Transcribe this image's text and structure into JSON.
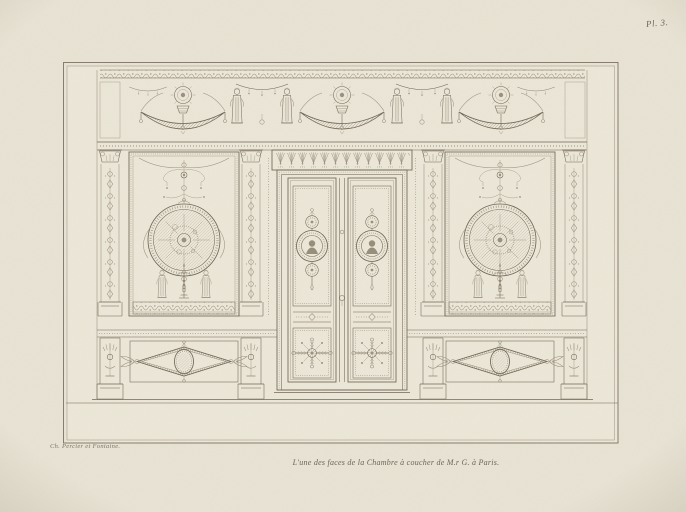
{
  "plate": {
    "number": "Pl. 3.",
    "signature": "Ch. Percier et Fontaine.",
    "caption": "L'une des faces de la Chambre à coucher de M.r G. à Paris."
  },
  "colors": {
    "paper": "#eae5d6",
    "margin_paper": "#e8e3d4",
    "ink": "#6e6555",
    "ink_light": "#9a9080"
  }
}
